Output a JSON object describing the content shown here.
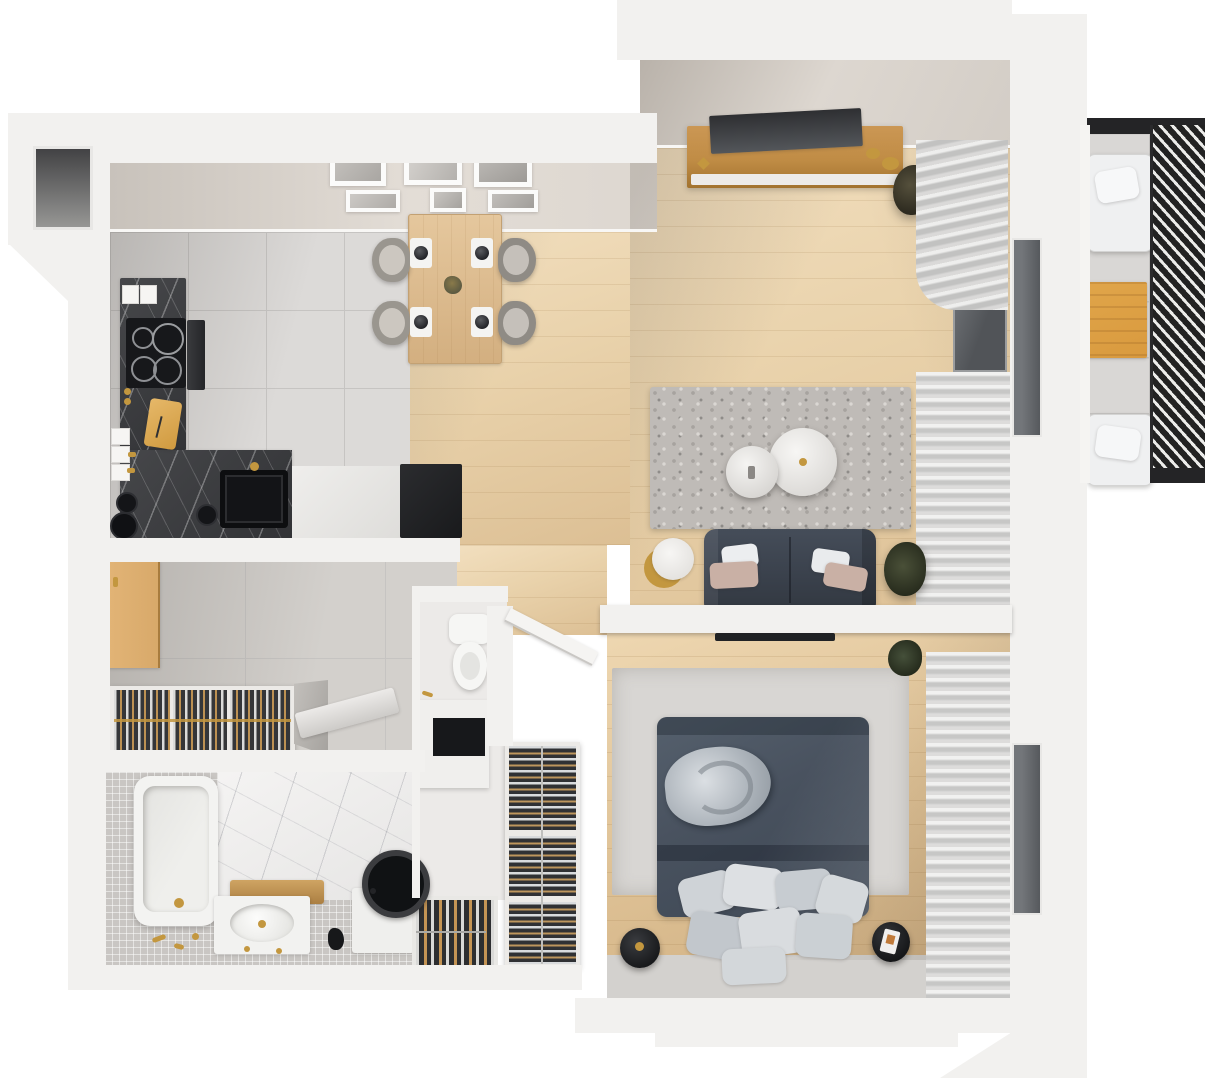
{
  "meta": {
    "kind": "3d-floor-plan-render",
    "view": "top-down isometric",
    "canvas_width": 1205,
    "canvas_height": 1080,
    "visible_text": ""
  },
  "palette": {
    "bg": "#ffffff",
    "wall": "#f2f1ef",
    "wallFace": "#d8d2cb",
    "wood": "#e9d2ab",
    "woodDark": "#ddc094",
    "tile": "#dcdad8",
    "tileHall": "#d3d0cc",
    "grout": "#c6c4c2",
    "counter": "#323336",
    "sofa": "#3a414c",
    "bed": "#49525f",
    "rugLiving": "#bfbbb7",
    "rugBedroom": "#d8d6d3",
    "gold": "#c3973f",
    "doorWood": "#d8a96a",
    "consoleWood": "#c08c45",
    "louver": "#222222",
    "fixture": "#f4f4f3",
    "dark": "#1b1c1e",
    "accentOrange": "#d99a3e",
    "plantGreen": "#4a4f3a",
    "blush": "#c9b0a5",
    "pillowLight": "#d3d7db"
  },
  "rooms": [
    {
      "id": "kitchen-dining",
      "label": "Kitchen and dining area",
      "floor": "grey tile + wood",
      "furniture": [
        "L-shaped dark marble counter",
        "induction cooktop 4 burners",
        "built-in oven",
        "black sink",
        "cutting board",
        "dark appliance block",
        "dining table",
        "4 chairs",
        "4 place settings with bowls",
        "table plant",
        "6 wall frames"
      ]
    },
    {
      "id": "living-room",
      "label": "Living room",
      "floor": "light wood",
      "furniture": [
        "wooden tv console",
        "flat tv panel",
        "gold decor",
        "floor plant",
        "shag rug",
        "large round coffee table",
        "small round coffee table",
        "two-seat sofa",
        "4 throw pillows",
        "round side table",
        "sofa plant",
        "curtains",
        "window"
      ]
    },
    {
      "id": "balcony",
      "label": "Balcony",
      "floor": "grey tile",
      "furniture": [
        "bench seat with cushion (top)",
        "orange coffee table",
        "bench seat with cushion (bottom)",
        "louvered privacy screen"
      ]
    },
    {
      "id": "bedroom",
      "label": "Bedroom",
      "floor": "light wood",
      "furniture": [
        "double bed with dark duvet",
        "rolled blanket",
        "pillow pile at foot",
        "round nightstand left",
        "round nightstand right with book",
        "wall tv",
        "open wardrobe column",
        "rug",
        "curtains",
        "window",
        "corner plant"
      ]
    },
    {
      "id": "hallway",
      "label": "Hallway",
      "floor": "grey tile",
      "furniture": [
        "entry door (open)",
        "triple hall closet with hangers",
        "folding board",
        "side wedge"
      ]
    },
    {
      "id": "wc",
      "label": "Toilet niche",
      "floor": "grey tile",
      "furniture": [
        "toilet",
        "black inset cabinet",
        "white partition"
      ]
    },
    {
      "id": "bathroom",
      "label": "Bathroom",
      "floor": "grey mosaic + marble",
      "furniture": [
        "bathtub with gold faucet",
        "vanity with oval sink and wood top",
        "washing machine with round black lid",
        "shoe rack with shoes",
        "gold accessories"
      ]
    }
  ]
}
